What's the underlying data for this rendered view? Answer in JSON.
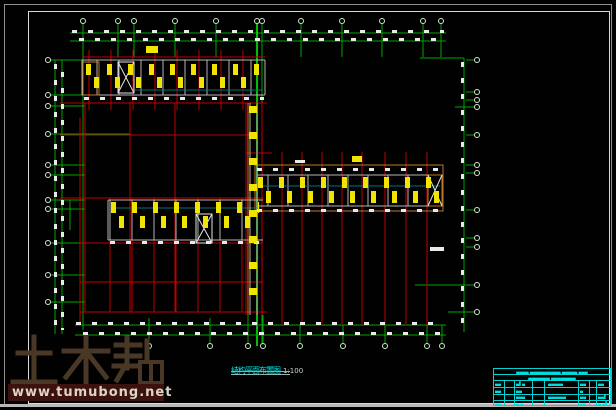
{
  "drawing": {
    "title": "结构平面布置图",
    "scale": "1:100"
  },
  "watermark": {
    "brand": "土木帮",
    "url": "www.tumubong.net"
  },
  "title_block": {
    "header_line1": "▄▄▄▄ ▄▄▄▄▄▄▄▄▄▄ ▄▄▄▄▄ ▄▄▄",
    "header_line2": "▄▄▄▄▄▄▄ ▄▄▄▄▄▄▄▄",
    "illegible_cells": {
      "c0": "▄▄",
      "c1": "▄▌▄",
      "c2": "▄▄▄▄▄",
      "c3": "▄▄",
      "c4": "▄▄",
      "c5": "▄▄",
      "c6": "▄▄",
      "c7": "▄",
      "c8": "▄▄▄",
      "c9": "▄▄▄▄▄▄",
      "c10": "▄▄",
      "c11": "▄▄▌",
      "c12": "▄▄",
      "c13": "▄ ▄",
      "c14": "▄▄",
      "c15": "▄ ▄▌"
    }
  },
  "colors": {
    "axis_green": "#00a800",
    "axis_green_bright": "#00ee00",
    "beam_red": "#c00000",
    "wall_gray": "#b4b4b4",
    "edge_orange": "#c07828",
    "column_yellow": "#f0e400",
    "annotation_cyan": "#00e0e0",
    "slab_teal": "#007272"
  }
}
